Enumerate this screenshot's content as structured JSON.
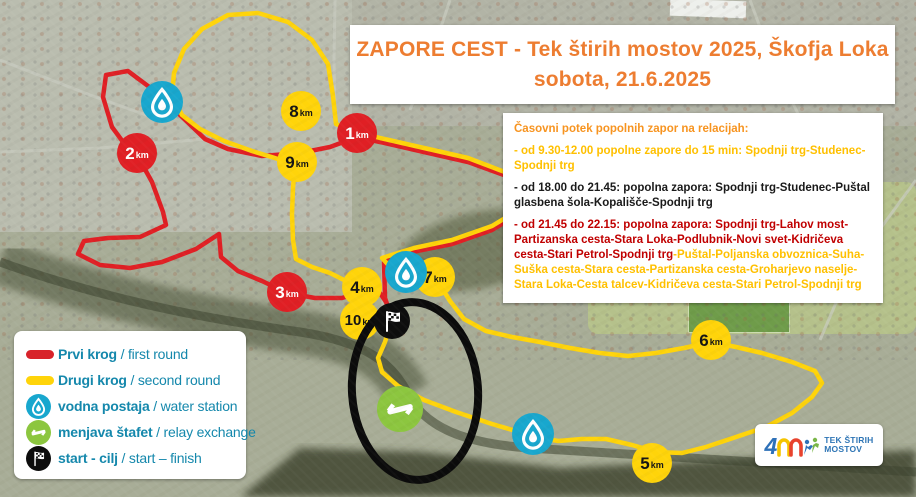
{
  "title": {
    "line1": "ZAPORE CEST  - Tek štirih mostov 2025, Škofja Loka",
    "line2": "sobota, 21.6.2025"
  },
  "info": {
    "heading": "Časovni potek popolnih zapor na relacijah:",
    "item1": "- od 9.30-12.00 popolne zapore do 15 min: Spodnji trg-Studenec-Spodnji trg",
    "item2": "- od 18.00 do 21.45: popolna zapora: Spodnji trg-Studenec-Puštal glasbena šola-Kopališče-Spodnji trg",
    "item3_red": "- od 21.45 do 22.15: popolna zapora: Spodnji trg-Lahov most-Partizanska cesta-Stara Loka-Podlubnik-Novi svet-Kidričeva cesta-Stari Petrol-Spodnji trg",
    "item3_yellow": "-Puštal-Poljanska obvoznica-Suha-Suška cesta-Stara cesta-Partizanska cesta-Groharjevo naselje-Stara Loka-Cesta talcev-Kidričeva cesta-Stari Petrol-Spodnji trg"
  },
  "legend": {
    "rows": [
      {
        "bold": "Prvi krog",
        "rest": " / first round"
      },
      {
        "bold": "Drugi krog",
        "rest": " / second round"
      },
      {
        "bold": "vodna postaja",
        "rest": " / water station"
      },
      {
        "bold": "menjava štafet",
        "rest": " / relay exchange"
      },
      {
        "bold": "start - cilj",
        "rest": " / start – finish"
      }
    ]
  },
  "markers": {
    "km": [
      {
        "num": "1",
        "unit": "km",
        "color": "red"
      },
      {
        "num": "2",
        "unit": "km",
        "color": "red"
      },
      {
        "num": "3",
        "unit": "km",
        "color": "red"
      },
      {
        "num": "4",
        "unit": "km",
        "color": "yellow"
      },
      {
        "num": "5",
        "unit": "km",
        "color": "yellow"
      },
      {
        "num": "6",
        "unit": "km",
        "color": "yellow"
      },
      {
        "num": "7",
        "unit": "km",
        "color": "yellow"
      },
      {
        "num": "8",
        "unit": "km",
        "color": "yellow"
      },
      {
        "num": "9",
        "unit": "km",
        "color": "yellow"
      },
      {
        "num": "10",
        "unit": "km",
        "color": "yellow"
      }
    ],
    "water_station_count": 3,
    "relay_exchange_count": 1,
    "start_finish_count": 1
  },
  "logo": {
    "brand_digit": "4",
    "line1": "TEK ŠTIRIH",
    "line2": "MOSTOV"
  },
  "colors": {
    "title_orange": "#ED7D31",
    "info_heading_orange": "#F79420",
    "route_first_round_red": "#E01F24",
    "route_second_round_yellow": "#FFD40A",
    "legend_teal": "#1588AC",
    "water_blue": "#18A7CE",
    "relay_green": "#8CC63F",
    "closure_red_text": "#C00000",
    "closure_yellow_text": "#FFC000",
    "start_finish_black": "#111111"
  }
}
